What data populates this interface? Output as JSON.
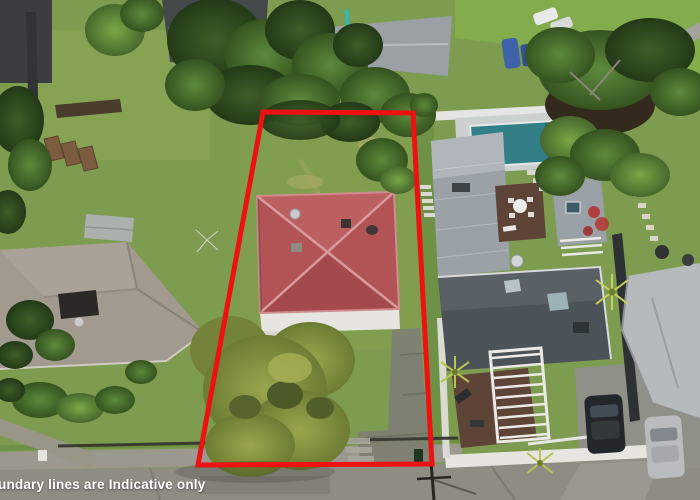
{
  "watermark": {
    "text": "undary lines are Indicative only"
  },
  "boundary": {
    "points": "263,112 413,113 432,464 198,465",
    "color": "#ed1111",
    "stroke_width": "5"
  },
  "palette": {
    "grass_base": "#7d9c4f",
    "lawn_bright": "#83ac4d",
    "verge_green": "#6f9145",
    "street": "#8e8d84",
    "footpath": "#9b998f",
    "red_roof": "#b25456",
    "red_roof_ridge": "#d89b9c",
    "left_roof": "#a39a8f",
    "top_dark_roof": "#45484b",
    "top_grey_roof": "#9aa0a4",
    "garage_roof": "#9aa2a8",
    "right_dark_roof": "#4b5358",
    "far_right_roof": "#b5babd",
    "small_grey_roof": "#9aa1a6",
    "pool_water": "#337f88",
    "pool_deck": "#ccd1d0",
    "deck_brown": "#5e4436",
    "white_wall": "#e7e5e0",
    "car_dark": "#23272b",
    "car_silver": "#b9bbbc",
    "playhouse_yellow": "#e3bf3a",
    "playhouse_blue": "#3a6fc4",
    "playhouse_red": "#bf3a33",
    "slide_teal": "#35b8b2",
    "boat_blue": "#3f63a9"
  }
}
